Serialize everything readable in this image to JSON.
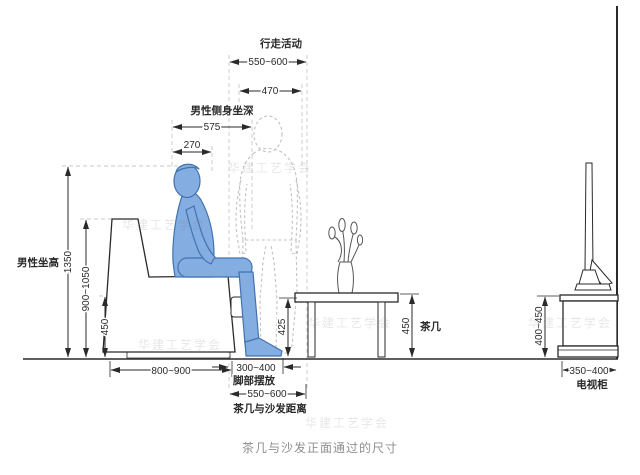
{
  "diagram": {
    "title": "茶几与沙发正面通过的尺寸",
    "watermark": "华建工艺学会",
    "top": {
      "walking_label": "行走活动",
      "walking_range": "550~600",
      "shoulder_width": "470",
      "sit_depth_label": "男性侧身坐深",
      "sit_depth": "575",
      "head_depth": "270"
    },
    "left": {
      "sit_height_label": "男性坐高",
      "total_height": "1350",
      "backrest_height": "900~1050",
      "seat_height": "450"
    },
    "bottom": {
      "sofa_depth": "800~900",
      "foot_zone": "300~400",
      "foot_zone_label": "脚部摆放",
      "gap_range": "550~600",
      "gap_label": "茶几与沙发距离"
    },
    "table": {
      "leg_clearance": "425",
      "height": "450",
      "label": "茶几"
    },
    "tv": {
      "height": "400~450",
      "width": "350~400",
      "label": "电视柜"
    },
    "colors": {
      "figure_fill": "#84ade2",
      "figure_stroke": "#4273ae",
      "line": "#2a2a2a",
      "title_gray": "#8f8f8f"
    }
  }
}
